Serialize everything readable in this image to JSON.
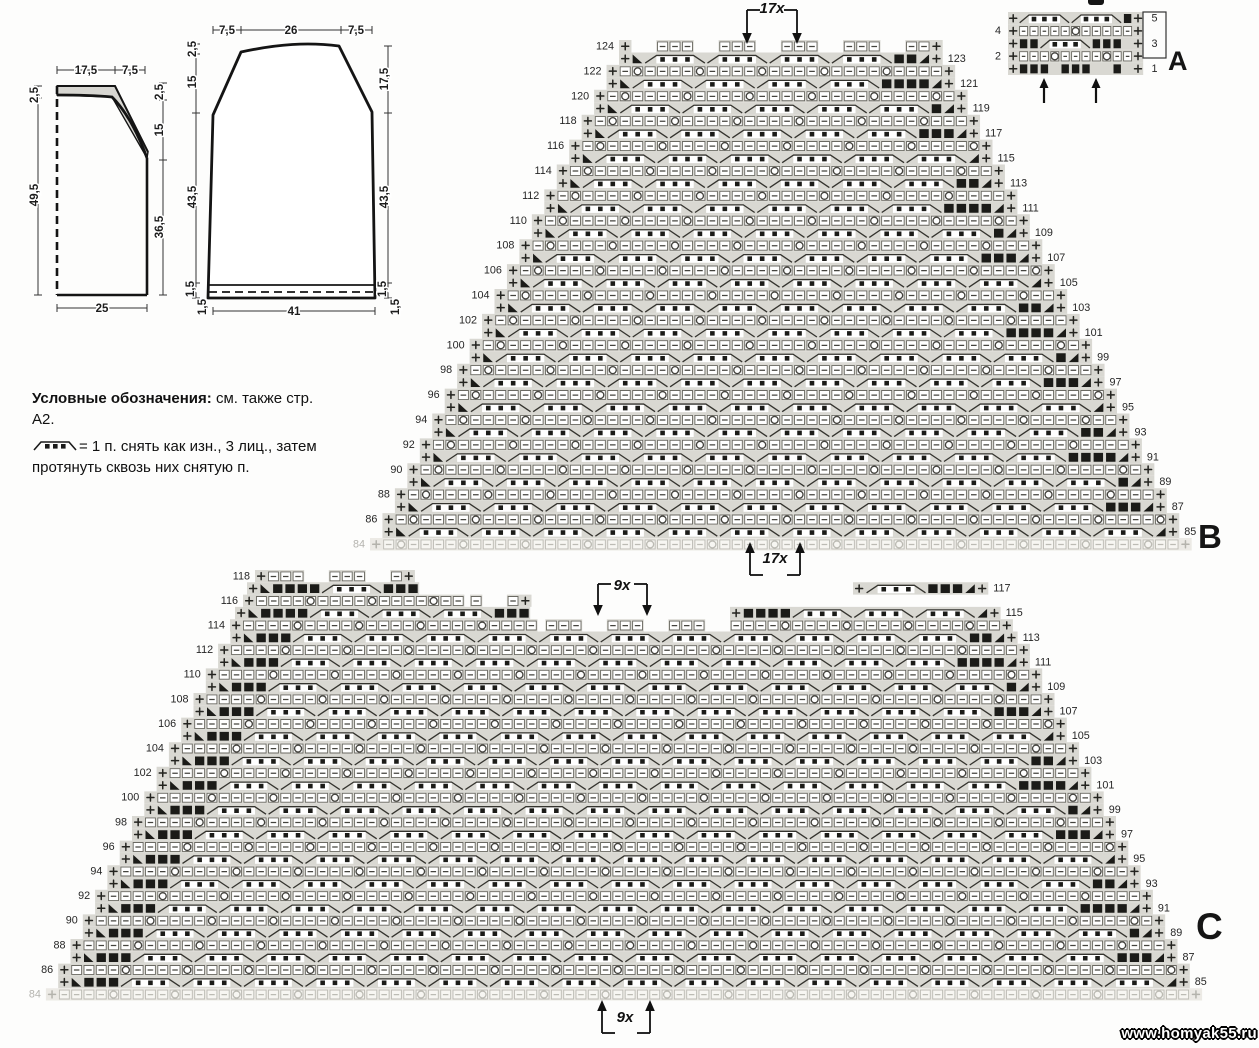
{
  "page": {
    "watermark": "www.homyak55.ru"
  },
  "legend": {
    "heading": "Условные обозначения:",
    "heading_rest": " см. также стр.",
    "line2": "А2.",
    "symbol_line1": "= 1 п. снять как изн., 3 лиц., затем",
    "symbol_line2": "протянуть сквозь них снятую п."
  },
  "schematics": [
    {
      "top": [
        "17,5",
        "7,5"
      ],
      "left": [
        "2,5",
        "49,5"
      ],
      "right": [
        "2,5",
        "15",
        "36,5"
      ],
      "bottom": "25"
    },
    {
      "top": [
        "7,5",
        "26",
        "7,5"
      ],
      "left": [
        "2,5",
        "15",
        "43,5",
        "1,5",
        "1,5"
      ],
      "right": [
        "17,5",
        "43,5",
        "1,5",
        "1,5"
      ],
      "bottom": "41"
    }
  ],
  "charts": {
    "A": {
      "letter": "A",
      "left_labels": [
        "4",
        "2"
      ],
      "right_labels": [
        "5",
        "3",
        "1"
      ],
      "grid": [
        [
          "p",
          "sl",
          "d",
          "d",
          "d",
          "sr",
          "sl",
          "d",
          "d",
          "d",
          "sr",
          "b",
          "p"
        ],
        [
          "p",
          "e",
          "e",
          "e",
          "e",
          "e",
          "o",
          "e",
          "e",
          "e",
          "e",
          "e",
          "p"
        ],
        [
          "p",
          "b",
          "b",
          "sl",
          "d",
          "d",
          "d",
          "sr",
          "b",
          "b",
          "b",
          "x",
          "p"
        ],
        [
          "p",
          "e",
          "e",
          "e",
          "o",
          "e",
          "e",
          "e",
          "e",
          "o",
          "e",
          "e",
          "p"
        ],
        [
          "p",
          "b",
          "b",
          "b",
          "x",
          "b",
          "b",
          "b",
          "x",
          "x",
          "b",
          "x",
          "p"
        ]
      ]
    },
    "B": {
      "letter": "B",
      "repeat_top": "17x",
      "repeat_bottom": "17x",
      "left_labels": [
        "124",
        "122",
        "120",
        "118",
        "116",
        "114",
        "112",
        "110",
        "108",
        "106",
        "104",
        "102",
        "100",
        "98",
        "96",
        "94",
        "92",
        "90",
        "88",
        "86"
      ],
      "right_labels": [
        "123",
        "121",
        "119",
        "117",
        "115",
        "113",
        "111",
        "109",
        "107",
        "105",
        "103",
        "101",
        "99",
        "97",
        "95",
        "93",
        "91",
        "89",
        "87",
        "85"
      ],
      "base_label": "84",
      "shaping": [
        {
          "i": 0,
          "segments": [
            {
              "x1": 619,
              "x2": 947,
              "style": "cap",
              "lp": 1,
              "rp": 1
            }
          ]
        }
      ]
    },
    "C": {
      "letter": "C",
      "repeat_top": "9x",
      "repeat_bottom": "9x",
      "left_labels": [
        "118",
        "116",
        "114",
        "112",
        "110",
        "108",
        "106",
        "104",
        "102",
        "100",
        "98",
        "96",
        "94",
        "92",
        "90",
        "88",
        "86"
      ],
      "right_labels": [
        "117",
        "115",
        "113",
        "111",
        "109",
        "107",
        "105",
        "103",
        "101",
        "99",
        "97",
        "95",
        "93",
        "91",
        "89",
        "87",
        "85"
      ],
      "base_label": "84",
      "shaping": [
        {
          "i": 0,
          "segments": [
            {
              "x1": 255,
              "x2": 417,
              "style": "cap",
              "lp": 1,
              "rp": 1
            }
          ]
        },
        {
          "i": 1,
          "segments": [
            {
              "x1": 247,
              "x2": 420,
              "style": "odd",
              "lp": 1,
              "ld": 1
            },
            {
              "x1": 853,
              "x2": 990,
              "style": "odd",
              "lp": 1,
              "rp": 1,
              "rd": 1
            }
          ]
        },
        {
          "i": 2,
          "segments": [
            {
              "x1": 243,
              "x2": 470,
              "style": "even",
              "lp": 1
            },
            {
              "x1": 470,
              "x2": 533,
              "style": "cap",
              "rp": 1
            }
          ]
        },
        {
          "i": 3,
          "segments": [
            {
              "x1": 235,
              "x2": 533,
              "style": "odd",
              "lp": 1,
              "ld": 1
            },
            {
              "x1": 730,
              "x2": 1004,
              "style": "odd",
              "lp": 1,
              "rp": 1,
              "rd": 1
            }
          ]
        },
        {
          "i": 4,
          "segments": [
            {
              "x1": 230,
              "x2": 533,
              "style": "even",
              "lp": 1
            },
            {
              "x1": 533,
              "x2": 730,
              "style": "cap"
            },
            {
              "x1": 730,
              "x2": 1017,
              "style": "even",
              "rp": 1
            }
          ]
        }
      ]
    }
  }
}
